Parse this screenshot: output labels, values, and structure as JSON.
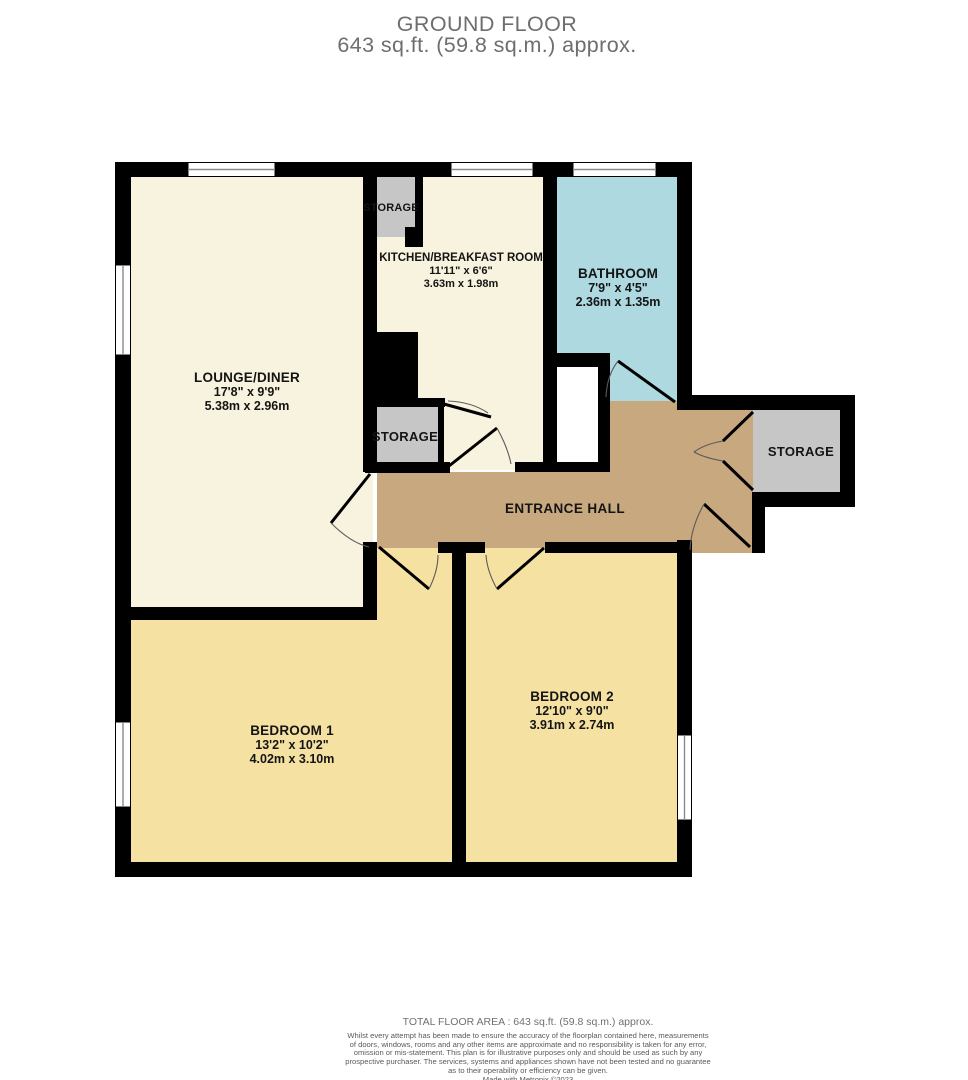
{
  "title": {
    "line1": "GROUND FLOOR",
    "line2": "643 sq.ft. (59.8 sq.m.) approx."
  },
  "rooms": {
    "lounge_diner": {
      "name": "LOUNGE/DINER",
      "imperial": "17'8\"  x 9'9\"",
      "metric": "5.38m  x 2.96m"
    },
    "kitchen": {
      "name": "KITCHEN/BREAKFAST ROOM",
      "imperial": "11'11\"  x 6'6\"",
      "metric": "3.63m  x 1.98m"
    },
    "bathroom": {
      "name": "BATHROOM",
      "imperial": "7'9\"  x 4'5\"",
      "metric": "2.36m  x 1.35m"
    },
    "bedroom_1": {
      "name": "BEDROOM 1",
      "imperial": "13'2\"  x 10'2\"",
      "metric": "4.02m  x 3.10m"
    },
    "bedroom_2": {
      "name": "BEDROOM 2",
      "imperial": "12'10\"  x 9'0\"",
      "metric": "3.91m  x 2.74m"
    },
    "entrance_hall": {
      "name": "ENTRANCE HALL"
    },
    "storage_kitchen": {
      "name": "STORAGE"
    },
    "storage_hall": {
      "name": "STORAGE"
    },
    "storage_right": {
      "name": "STORAGE"
    }
  },
  "footer": {
    "total_area": "TOTAL FLOOR AREA : 643 sq.ft. (59.8 sq.m.) approx.",
    "disclaimer_lines": [
      "Whilst every attempt has been made to ensure the accuracy of the floorplan contained here, measurements",
      "of doors, windows, rooms and any other items are approximate and no responsibility is taken for any error,",
      "omission or mis-statement. This plan is for illustrative purposes only and should be used as such by any",
      "prospective purchaser. The services, systems and appliances shown have not been tested and no guarantee",
      "as to their operability or efficiency can be given."
    ],
    "credit": "Made with Metropix ©2023"
  },
  "colors": {
    "wall": "#000000",
    "lounge_kitchen_floor": "#F8F3DE",
    "bedroom_floor": "#F5E2A3",
    "bathroom_floor": "#AED9E1",
    "hall_floor": "#C8A87F",
    "storage_floor": "#C6C6C6",
    "title_text": "#6E6E6E"
  }
}
